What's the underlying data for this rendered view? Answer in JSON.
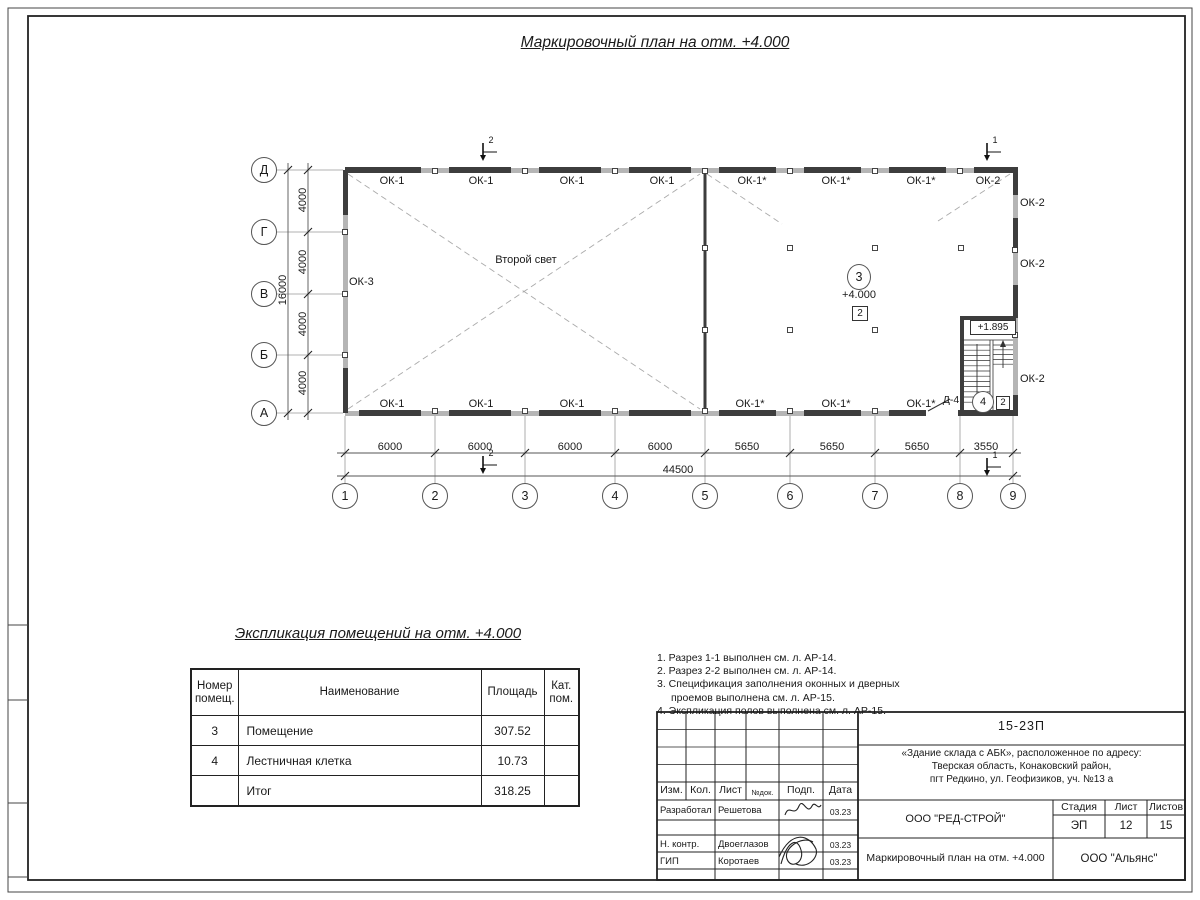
{
  "sheet": {
    "title": "Маркировочный план на отм. +4.000",
    "explication_title": "Экспликация помещений на отм. +4.000"
  },
  "colors": {
    "wall_gray": "#b5b5b5",
    "wall_dark": "#3d3d3d",
    "line": "#1a1a1a"
  },
  "plan": {
    "top_windows": [
      "ОК-1",
      "ОК-1",
      "ОК-1",
      "ОК-1",
      "ОК-1*",
      "ОК-1*",
      "ОК-1*",
      "ОК-2"
    ],
    "bottom_windows": [
      "ОК-1",
      "ОК-1",
      "ОК-1",
      "ОК-1*",
      "ОК-1*",
      "ОК-1*"
    ],
    "right_windows": [
      "ОК-2",
      "ОК-2",
      "ОК-2"
    ],
    "left_window": "ОК-3",
    "second_light": "Второй свет",
    "room": {
      "num": "3",
      "elev": "+4.000",
      "zone": "2"
    },
    "stair": {
      "elev": "+1.895",
      "door": "Д-4",
      "num": "4",
      "zone": "2"
    }
  },
  "axes": {
    "rows": [
      "Д",
      "Г",
      "В",
      "Б",
      "А"
    ],
    "cols": [
      "1",
      "2",
      "3",
      "4",
      "5",
      "6",
      "7",
      "8",
      "9"
    ]
  },
  "dims": {
    "bottom": [
      "6000",
      "6000",
      "6000",
      "6000",
      "5650",
      "5650",
      "5650",
      "3550"
    ],
    "bottom_total": "44500",
    "left": [
      "4000",
      "4000",
      "4000",
      "4000"
    ],
    "left_total": "16000"
  },
  "sections": {
    "mark2": "2",
    "mark1": "1"
  },
  "explication": {
    "headers": [
      "Номер помещ.",
      "Наименование",
      "Площадь",
      "Кат. пом."
    ],
    "rows": [
      {
        "num": "3",
        "name": "Помещение",
        "area": "307.52",
        "cat": ""
      },
      {
        "num": "4",
        "name": "Лестничная клетка",
        "area": "10.73",
        "cat": ""
      },
      {
        "num": "",
        "name": "Итог",
        "area": "318.25",
        "cat": ""
      }
    ]
  },
  "notes": [
    "1. Разрез 1-1 выполнен см. л. АР-14.",
    "2. Разрез 2-2 выполнен см. л. АР-14.",
    "3. Спецификация заполнения оконных и дверных",
    "проемов выполнена см. л. АР-15.",
    "4. Экспликация полов выполнена см. л. АР-15."
  ],
  "titleblock": {
    "doc_number": "15-23П",
    "address_lines": [
      "«Здание склада с АБК», расположенное по адресу:",
      "Тверская область, Конаковский район,",
      "пгт Редкино, ул. Геофизиков, уч. №13 а"
    ],
    "header_cells": [
      "Изм.",
      "Кол.",
      "Лист",
      "№док.",
      "Подп.",
      "Дата"
    ],
    "roles": [
      {
        "role": "Разработал",
        "name": "Решетова",
        "date": "03.23"
      },
      {
        "role": "Н. контр.",
        "name": "Двоеглазов",
        "date": "03.23"
      },
      {
        "role": "ГИП",
        "name": "Коротаев",
        "date": "03.23"
      }
    ],
    "company": "ООО \"РЕД-СТРОЙ\"",
    "stage_label": "Стадия",
    "sheet_label": "Лист",
    "sheets_label": "Листов",
    "stage": "ЭП",
    "sheet_no": "12",
    "sheets_total": "15",
    "drawing_name": "Маркировочный план на отм. +4.000",
    "contractor": "ООО \"Альянс\""
  }
}
